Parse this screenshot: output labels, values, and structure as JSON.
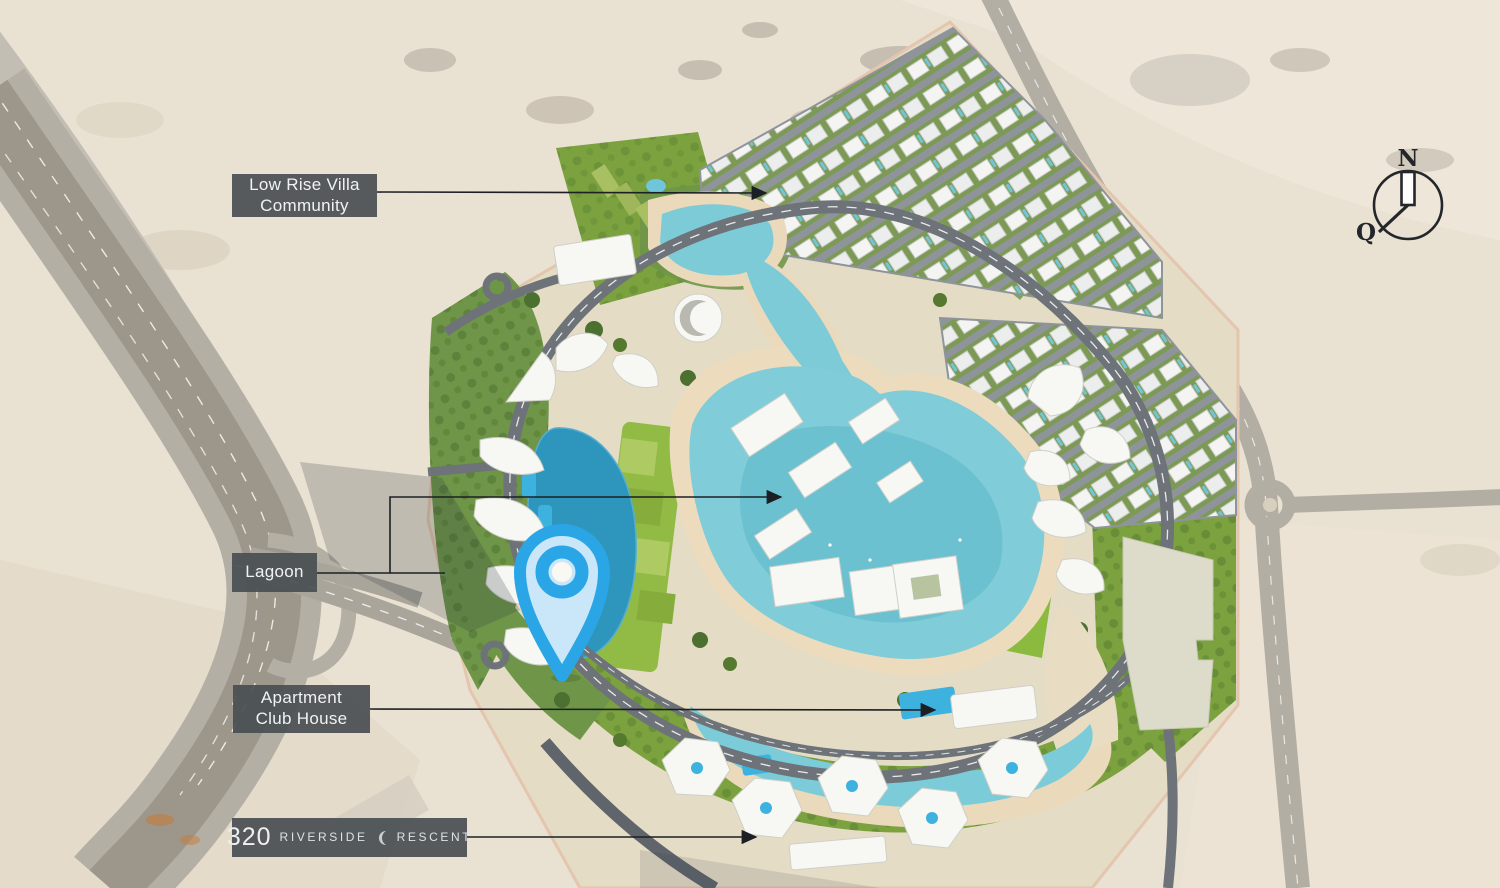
{
  "page": {
    "type": "development-masterplan-map"
  },
  "annotations": {
    "low_rise_villa": {
      "line1": "Low Rise Villa",
      "line2": "Community"
    },
    "lagoon": {
      "text": "Lagoon"
    },
    "apartment_club_house": {
      "line1": "Apartment",
      "line2": "Club House"
    },
    "riverside_320": {
      "number": "320",
      "word1": "RIVERSIDE",
      "word2": "RESCENT"
    }
  },
  "compass": {
    "north_label": "N",
    "qibla_label": "Q"
  },
  "map_pin": {
    "name": "location-pin"
  },
  "colors": {
    "label_background": "rgba(73,78,82,0.92)",
    "label_text": "#f1f2f2",
    "desert_sand": "#e9e1d2",
    "site_ground": "#e5dcc6",
    "greenery": "#7ba23e",
    "tree_green": "#4c7030",
    "lagoon_water": "#80ccd9",
    "deep_lagoon_water": "#2e96bc",
    "pool_blue": "#3db2de",
    "beach_sand": "#ecdcbd",
    "road_gray": "#6d7378",
    "highway_gray": "#b4afa4",
    "building_white": "#f7f7f4",
    "leader_line": "#1c2024",
    "pin_blue": "#2aa6e6",
    "pin_fill": "#c9e7f9",
    "compass_ink": "#23272b"
  }
}
